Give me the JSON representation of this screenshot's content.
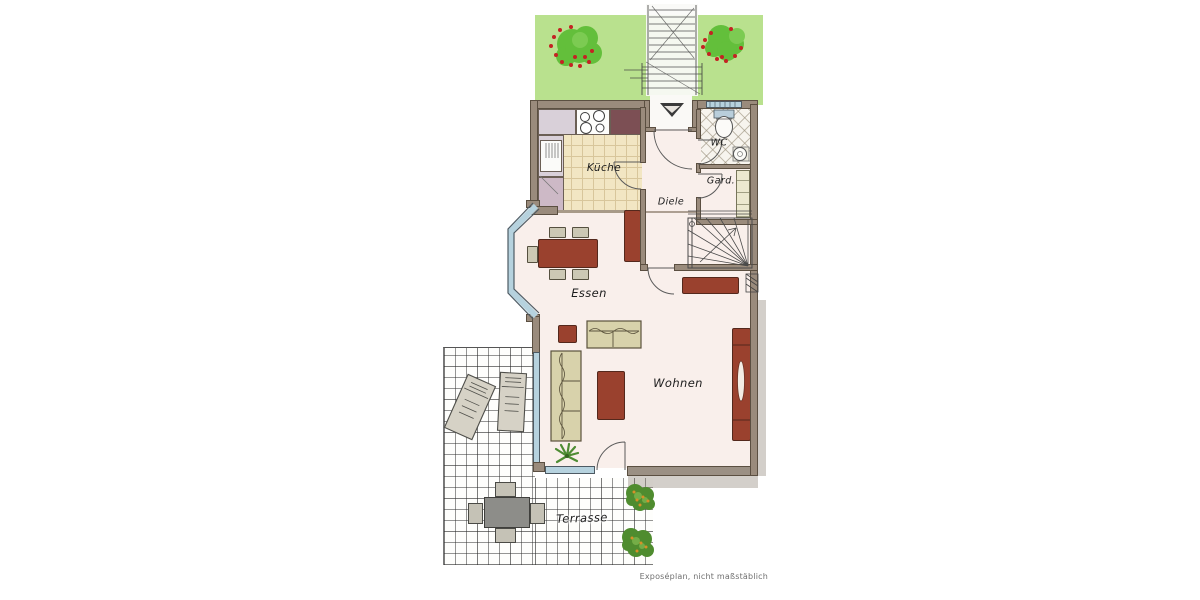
{
  "meta": {
    "caption": "Exposéplan, nicht maßstäblich"
  },
  "rooms": [
    {
      "id": "kueche",
      "label": "Küche"
    },
    {
      "id": "wc",
      "label": "WC"
    },
    {
      "id": "garderobe",
      "label": "Gard."
    },
    {
      "id": "diele",
      "label": "Diele"
    },
    {
      "id": "essen",
      "label": "Essen"
    },
    {
      "id": "wohnen",
      "label": "Wohnen"
    },
    {
      "id": "terrasse",
      "label": "Terrasse"
    }
  ],
  "colors": {
    "garden": "#b9e18e",
    "tree": "#63bf3b",
    "tree_light": "#7ccb52",
    "berry": "#c42323",
    "wall": "#9a8b7c",
    "wall_dark": "#5b4f41",
    "floor": "#f9efeb",
    "kitchen_floor": "#f2e6c3",
    "kitchen_grid": "#d8c69b",
    "window_blue": "#b6d2de",
    "window_frame": "#4d5a63",
    "furn_red": "#9a412e",
    "furn_red_dark": "#54281c",
    "sofa": "#d8d2ab",
    "sofa_dark": "#5a523c",
    "terrace_table": "#8d8d89",
    "terrace_chair": "#c5c2b6",
    "ink": "#1c1c1c",
    "caption": "#707070"
  }
}
